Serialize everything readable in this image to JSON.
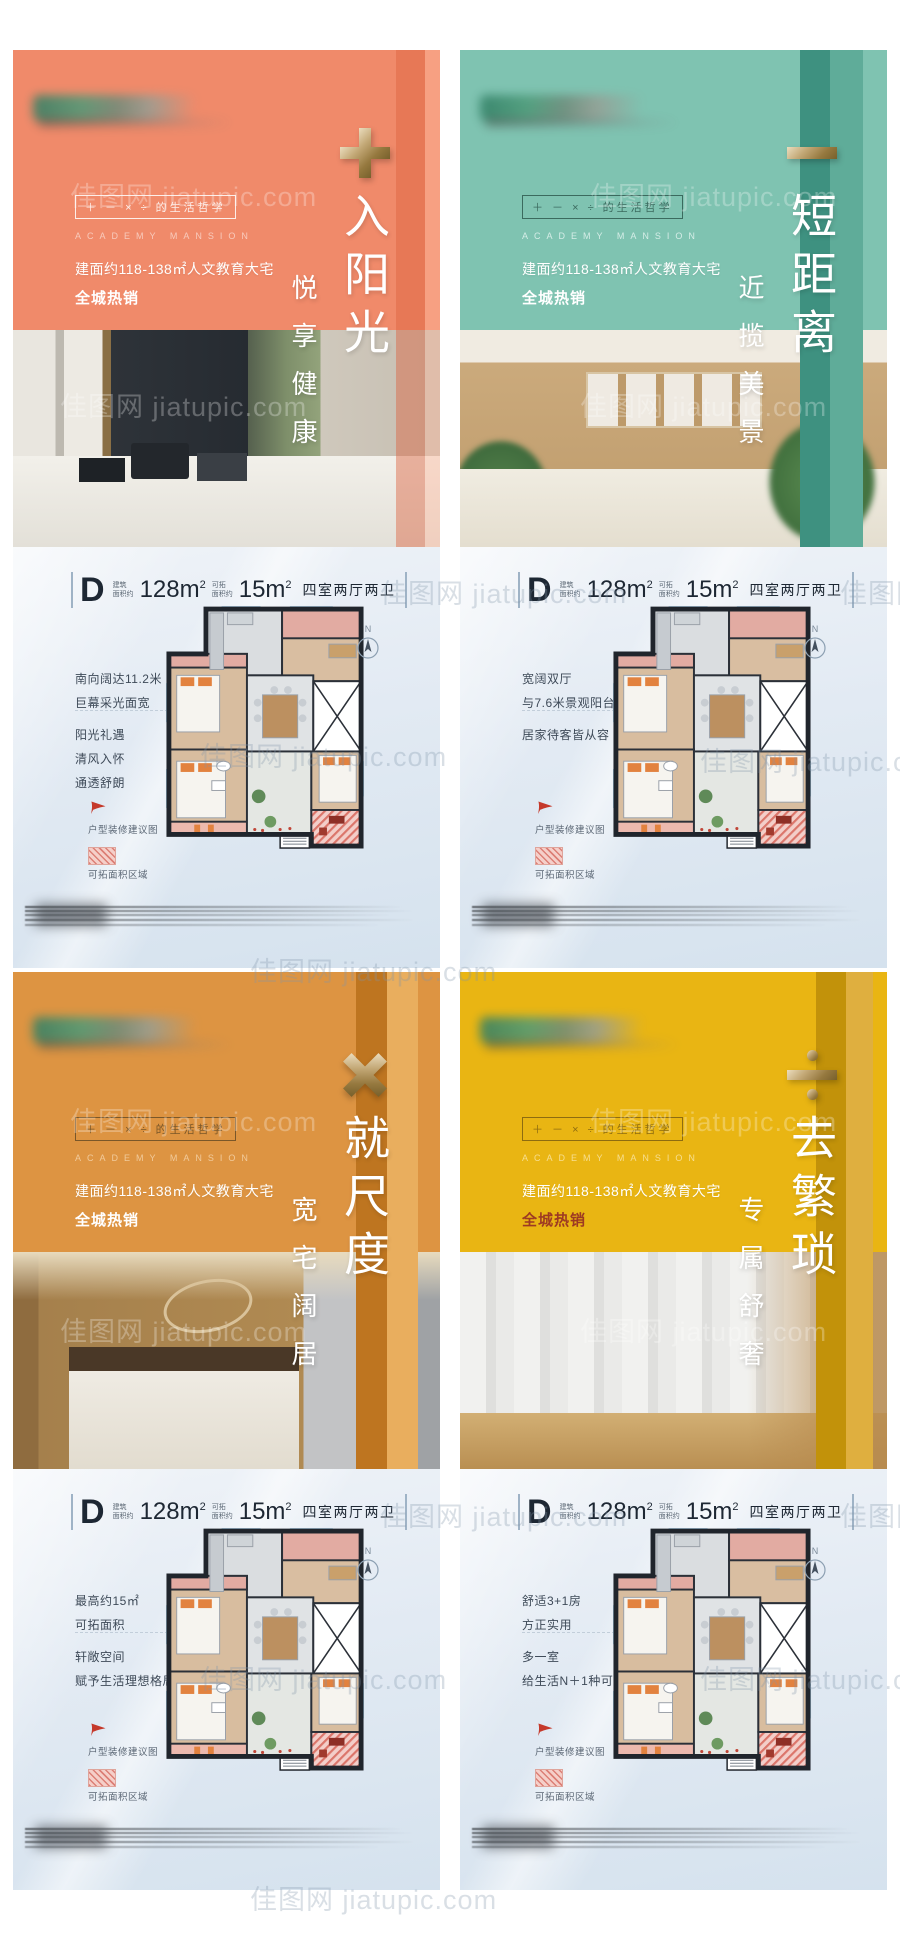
{
  "page": {
    "watermark": "佳图网 jiatupic.com"
  },
  "shared": {
    "philosophy": "＋ － × ÷ 的生活哲学",
    "brand_en": "ACADEMY MANSION",
    "desc": "建面约118-138㎡人文教育大宅",
    "spec": {
      "unit": "D",
      "label1_a": "建筑",
      "label1_b": "面积约",
      "area1": "128m",
      "area1_sup": "2",
      "label2_a": "可拓",
      "label2_b": "面积约",
      "area2": "15m",
      "area2_sup": "2",
      "rooms": "四室两厅两卫"
    },
    "legend": {
      "flag": "户型装修建议图",
      "area": "可拓面积区域"
    },
    "compass_n": "N"
  },
  "posters": [
    {
      "op": "plus",
      "headline": "入阳光",
      "subline": "悦享健康",
      "hot": "全城热销",
      "colors": {
        "base": "#F08A6A",
        "hot": "#FFFFFF",
        "philo": "rgba(255,255,255,0.85)",
        "brand": "rgba(255,255,255,0.55)"
      },
      "plan": {
        "features_top": [
          "南向阔达11.2米",
          "巨幕采光面宽"
        ],
        "features_bottom": [
          "阳光礼遇",
          "清风入怀",
          "通透舒朗"
        ]
      }
    },
    {
      "op": "minus",
      "headline": "短距离",
      "subline": "近揽美景",
      "hot": "全城热销",
      "colors": {
        "base": "#7FC3B1",
        "hot": "#FFFFFF",
        "philo": "rgba(42,84,74,0.8)",
        "brand": "rgba(250,255,253,0.7)"
      },
      "plan": {
        "features_top": [
          "宽阔双厅",
          "与7.6米景观阳台相连"
        ],
        "features_bottom": [
          "居家待客皆从容"
        ]
      }
    },
    {
      "op": "times",
      "headline": "就尺度",
      "subline": "宽宅阔居",
      "hot": "全城热销",
      "colors": {
        "base": "#DD9442",
        "hot": "#FFFFFF",
        "philo": "rgba(97,71,35,0.8)",
        "brand": "rgba(255,238,214,0.6)"
      },
      "plan": {
        "features_top": [
          "最高约15㎡",
          "可拓面积"
        ],
        "features_bottom": [
          "轩敞空间",
          "赋予生活理想格局"
        ]
      }
    },
    {
      "op": "divide",
      "headline": "去繁琐",
      "subline": "专属舒奢",
      "hot": "全城热销",
      "colors": {
        "base": "#E9B513",
        "hot": "#9D3A23",
        "philo": "rgba(126,95,16,0.85)",
        "brand": "rgba(255,244,210,0.65)"
      },
      "plan": {
        "features_top": [
          "舒适3+1房",
          "方正实用"
        ],
        "features_bottom": [
          "多一室",
          "给生活N＋1种可能"
        ]
      }
    }
  ]
}
